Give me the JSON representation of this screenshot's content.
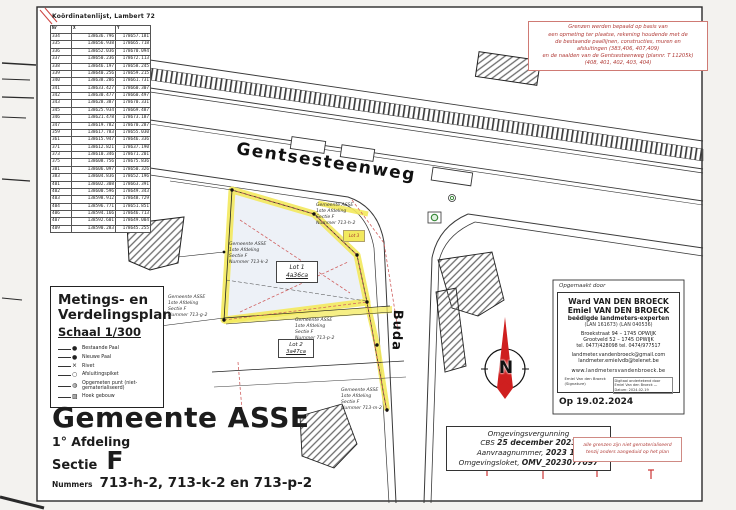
{
  "colors": {
    "highlight_yellow": "#f3e95c",
    "north_arrow_red": "#cf1f1f",
    "note_red": "#b03a36"
  },
  "coord_table": {
    "title": "Koördinatenlijst, Lambert 72",
    "columns": [
      "Nr",
      "X",
      "Y"
    ],
    "rows": [
      [
        "334",
        "138636.796",
        "178657.181"
      ],
      [
        "335",
        "138656.938",
        "178665.718"
      ],
      [
        "336",
        "138652.036",
        "178670.094"
      ],
      [
        "337",
        "138650.236",
        "178672.113"
      ],
      [
        "338",
        "138646.197",
        "178658.245"
      ],
      [
        "339",
        "138640.256",
        "178659.215"
      ],
      [
        "340",
        "138638.286",
        "178661.731"
      ],
      [
        "341",
        "138633.427",
        "178660.307"
      ],
      [
        "342",
        "138630.477",
        "178660.497"
      ],
      [
        "343",
        "138628.387",
        "178670.331"
      ],
      [
        "345",
        "138625.934",
        "178669.487"
      ],
      [
        "346",
        "138621.478",
        "178673.187"
      ],
      [
        "347",
        "138619.782",
        "178670.287"
      ],
      [
        "359",
        "138617.783",
        "178655.030"
      ],
      [
        "361",
        "138615.947",
        "178646.336"
      ],
      [
        "371",
        "138612.821",
        "178637.190"
      ],
      [
        "373",
        "138610.346",
        "178671.201"
      ],
      [
        "375",
        "138608.756",
        "178675.836"
      ],
      [
        "381",
        "138606.097",
        "178650.326"
      ],
      [
        "383",
        "138604.836",
        "178652.196"
      ],
      [
        "401",
        "138602.308",
        "178663.391"
      ],
      [
        "402",
        "138600.596",
        "178649.343"
      ],
      [
        "403",
        "138598.912",
        "178648.729"
      ],
      [
        "404",
        "138596.771",
        "178651.851"
      ],
      [
        "406",
        "138594.166",
        "178646.713"
      ],
      [
        "407",
        "138592.601",
        "178649.004"
      ],
      [
        "409",
        "138590.283",
        "178645.255"
      ]
    ]
  },
  "note_top_right": {
    "lines": [
      "Grenzen werden bepaald op basis van",
      "een opmeting ter plaatse, rekening houdende met de",
      "de bestaande paallijnen, constructies, muren en",
      "afsluitingen (383,406, 407,409)",
      "en de naalden van de Gentsesteenweg (plannr. T 11205k)",
      "(408, 401, 402, 403, 404)"
    ]
  },
  "plan_title": {
    "line1": "Metings- en",
    "line2": "Verdelingsplan",
    "scale": "Schaal 1/300"
  },
  "legend": {
    "items": [
      {
        "glyph": "●",
        "label": "Bestaande Paal"
      },
      {
        "glyph": "●",
        "label": "Nieuwe Paal"
      },
      {
        "glyph": "⨯",
        "label": "Rivet"
      },
      {
        "glyph": "○",
        "label": "Afsluitingspiket"
      },
      {
        "glyph": "◍",
        "label": "Opgemeten punt (niet-gematerialiseerd)"
      },
      {
        "glyph": "▨",
        "label": "Hoek gebouw"
      }
    ]
  },
  "municipality": {
    "name": "Gemeente ASSE",
    "afdeling": "1° Afdeling",
    "sectie_label": "Sectie",
    "sectie_value": "F",
    "nummers_label": "Nummers",
    "nummers_value": "713-h-2, 713-k-2 en 713-p-2"
  },
  "surveyor": {
    "prepared_by": "Opgemaakt door",
    "name1": "Ward VAN DEN BROECK",
    "name2": "Emiel VAN DEN BROECK",
    "title": "beëdigde landmeters-experten",
    "lan": "(LAN 161673)    (LAN 040536)",
    "address1": "Broekstraat 94 – 1745 OPWIJK",
    "address2": "Grootveld 52 – 1745 OPWIJK",
    "phones": "tel. 0477/428098    tel. 0474/977517",
    "email1": "landmeter.vandenbroeck@gmail.com",
    "email2": "landmeter.emielvdb@telenet.be",
    "website": "www.landmetersvandenbroeck.be",
    "signature_left": "Emiel Van den Broeck (Signature)",
    "signature_right": "Digitaal ondertekend door Emiel Van den Broeck — Datum: 2024.02.19",
    "date": "Op 19.02.2024"
  },
  "permit": {
    "l1": "Omgevingsvergunning",
    "l2a": "CBS",
    "l2b": "25 december 2023",
    "l3a": "Aanvraagnummer,",
    "l3b": "2023 14",
    "l4a": "Omgevingsloket,",
    "l4b": "OMV_2023077097"
  },
  "note_bottom_right": {
    "lines": [
      "alle grenzen zijn niet gematerialiseerd",
      "tenzij anders aangeduid op het plan"
    ]
  },
  "map": {
    "street_main": "Gentsesteenweg",
    "street_side": "Buda",
    "compass": "N",
    "lots": [
      {
        "name": "Lot 1",
        "area": "4a36ca"
      },
      {
        "name": "Lot 2",
        "area": "3a47ca"
      },
      {
        "name": "Lot 3",
        "area": ""
      }
    ],
    "parcel_labels": [
      {
        "l1": "Gemeente ASSE",
        "l2": "1ste Afdeling",
        "l3": "Sectie F",
        "l4": "Nummer 713-h-2"
      },
      {
        "l1": "Gemeente ASSE",
        "l2": "1ste Afdeling",
        "l3": "Sectie F",
        "l4": "Nummer 713-k-2"
      },
      {
        "l1": "Gemeente ASSE",
        "l2": "1ste Afdeling",
        "l3": "Sectie F",
        "l4": "Nummer 713-g-2"
      },
      {
        "l1": "Gemeente ASSE",
        "l2": "1ste Afdeling",
        "l3": "Sectie F",
        "l4": "Nummer 713-p-2"
      },
      {
        "l1": "Gemeente ASSE",
        "l2": "1ste Afdeling",
        "l3": "Sectie F",
        "l4": "Nummer 713-m-2"
      }
    ]
  }
}
